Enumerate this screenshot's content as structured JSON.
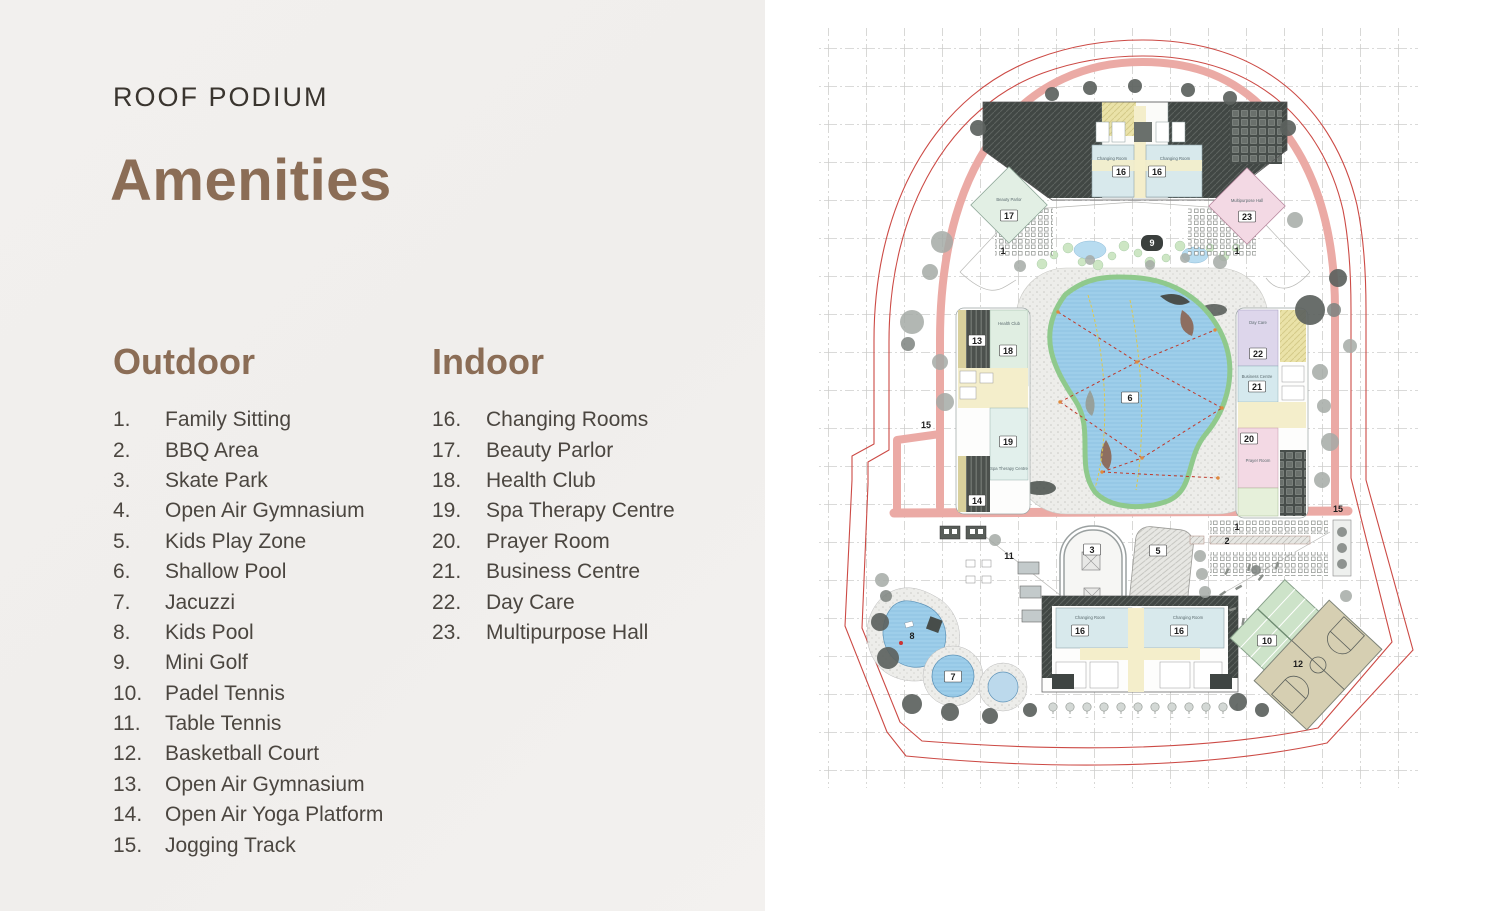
{
  "page": {
    "kicker": "ROOF PODIUM",
    "title": "Amenities"
  },
  "lists": {
    "outdoor": {
      "heading": "Outdoor",
      "items": [
        {
          "num": "1.",
          "label": "Family Sitting"
        },
        {
          "num": "2.",
          "label": "BBQ Area"
        },
        {
          "num": "3.",
          "label": "Skate Park"
        },
        {
          "num": "4.",
          "label": "Open Air Gymnasium"
        },
        {
          "num": "5.",
          "label": "Kids Play Zone"
        },
        {
          "num": "6.",
          "label": "Shallow Pool"
        },
        {
          "num": "7.",
          "label": "Jacuzzi"
        },
        {
          "num": "8.",
          "label": "Kids Pool"
        },
        {
          "num": "9.",
          "label": "Mini Golf"
        },
        {
          "num": "10.",
          "label": "Padel Tennis"
        },
        {
          "num": "11.",
          "label": "Table Tennis"
        },
        {
          "num": "12.",
          "label": "Basketball Court"
        },
        {
          "num": "13.",
          "label": "Open Air Gymnasium"
        },
        {
          "num": "14.",
          "label": "Open Air Yoga Platform"
        },
        {
          "num": "15.",
          "label": "Jogging Track"
        }
      ]
    },
    "indoor": {
      "heading": "Indoor",
      "items": [
        {
          "num": "16.",
          "label": "Changing Rooms"
        },
        {
          "num": "17.",
          "label": "Beauty Parlor"
        },
        {
          "num": "18.",
          "label": "Health Club"
        },
        {
          "num": "19.",
          "label": "Spa Therapy Centre"
        },
        {
          "num": "20.",
          "label": "Prayer Room"
        },
        {
          "num": "21.",
          "label": "Business Centre"
        },
        {
          "num": "22.",
          "label": "Day Care"
        },
        {
          "num": "23.",
          "label": "Multipurpose Hall"
        }
      ]
    }
  },
  "map": {
    "markers": {
      "1": "1",
      "2": "2",
      "3": "3",
      "5": "5",
      "6": "6",
      "7": "7",
      "8": "8",
      "9": "9",
      "10": "10",
      "11": "11",
      "12": "12",
      "13": "13",
      "14": "14",
      "15": "15",
      "16": "16",
      "17": "17",
      "18": "18",
      "19": "19",
      "20": "20",
      "21": "21",
      "22": "22",
      "23": "23"
    },
    "room_labels": {
      "changing_room": "Changing Room",
      "beauty_parlor": "Beauty Parlor",
      "multipurpose_hall": "Multipurpose Hall",
      "health_club": "Health Club",
      "spa": "Spa Therapy Centre",
      "day_care": "Day Care",
      "business_centre": "Business Centre",
      "prayer_room": "Prayer Room"
    }
  },
  "colors": {
    "brand_brown": "#8b6d56",
    "body_text": "#4b4640",
    "boundary_red": "#cc4a45",
    "track_salmon": "#ebaaa5",
    "pool_blue": "#a3d2ec"
  }
}
